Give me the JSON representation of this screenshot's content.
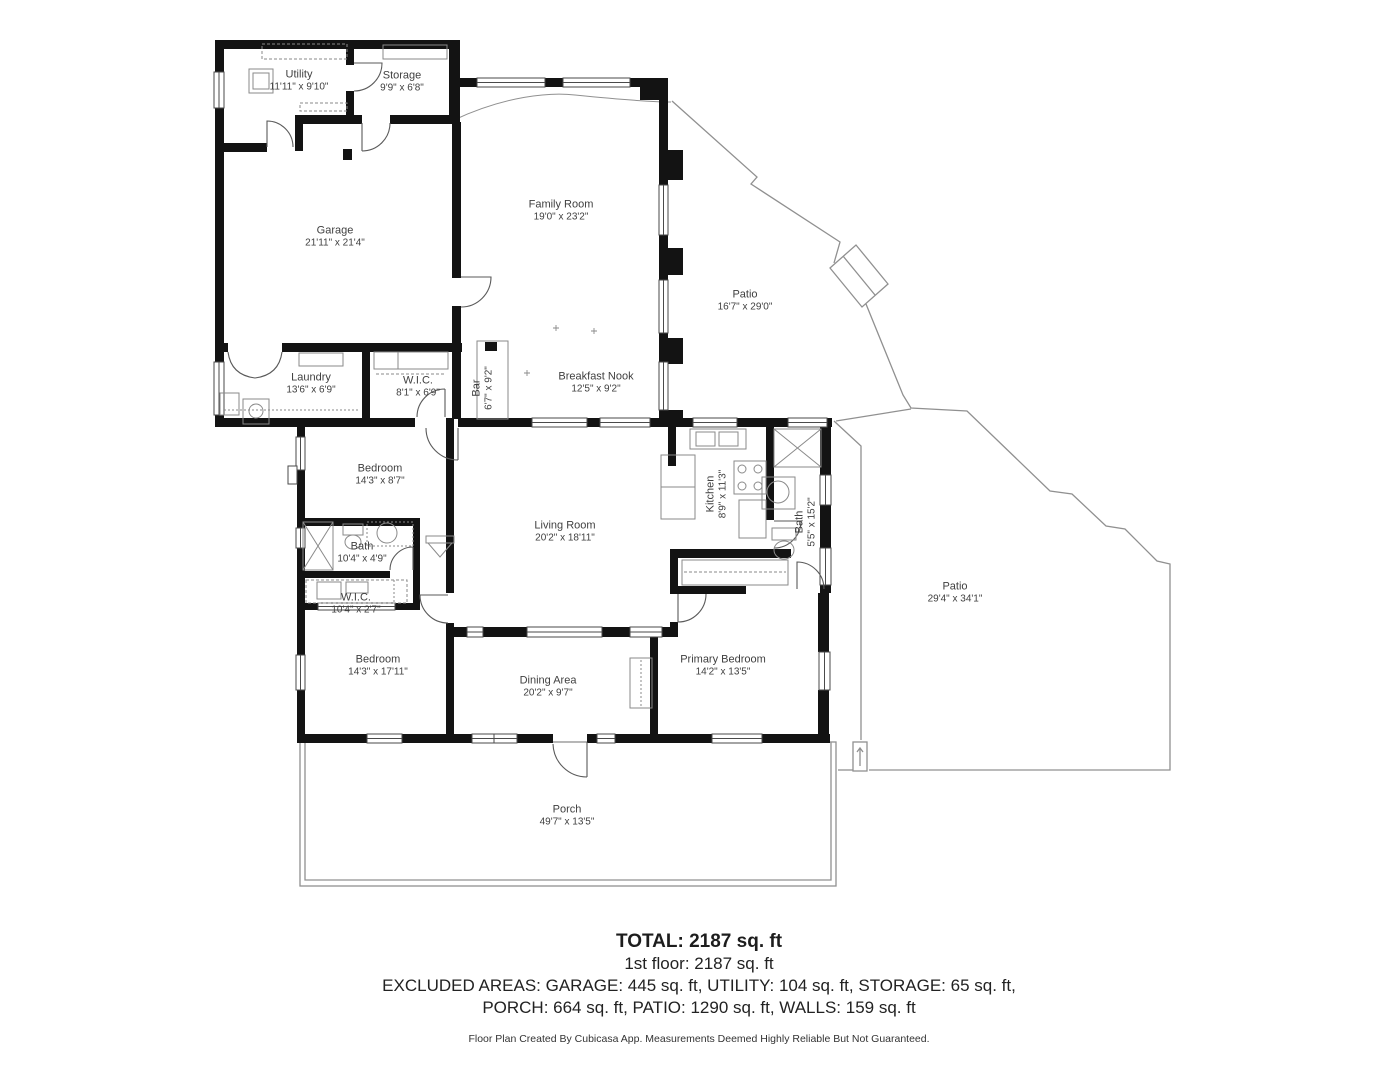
{
  "rooms": {
    "utility": {
      "name": "Utility",
      "dims": "11'11\" x 9'10\""
    },
    "storage": {
      "name": "Storage",
      "dims": "9'9\" x 6'8\""
    },
    "garage": {
      "name": "Garage",
      "dims": "21'11\" x 21'4\""
    },
    "family_room": {
      "name": "Family Room",
      "dims": "19'0\" x 23'2\""
    },
    "patio_upper": {
      "name": "Patio",
      "dims": "16'7\" x 29'0\""
    },
    "laundry": {
      "name": "Laundry",
      "dims": "13'6\" x 6'9\""
    },
    "wic_upper": {
      "name": "W.I.C.",
      "dims": "8'1\" x 6'9\""
    },
    "bar": {
      "name": "Bar",
      "dims": "6'7\" x 9'2\""
    },
    "breakfast_nook": {
      "name": "Breakfast Nook",
      "dims": "12'5\" x 9'2\""
    },
    "bedroom_upper": {
      "name": "Bedroom",
      "dims": "14'3\" x 8'7\""
    },
    "kitchen": {
      "name": "Kitchen",
      "dims": "8'9\" x 11'3\""
    },
    "bath_right": {
      "name": "Bath",
      "dims": "5'5\" x 15'2\""
    },
    "living_room": {
      "name": "Living Room",
      "dims": "20'2\" x 18'11\""
    },
    "bath_left": {
      "name": "Bath",
      "dims": "10'4\" x 4'9\""
    },
    "wic_lower": {
      "name": "W.I.C.",
      "dims": "10'4\" x 2'7\""
    },
    "bedroom_lower": {
      "name": "Bedroom",
      "dims": "14'3\" x 17'11\""
    },
    "dining_area": {
      "name": "Dining Area",
      "dims": "20'2\" x 9'7\""
    },
    "primary_bedroom": {
      "name": "Primary Bedroom",
      "dims": "14'2\" x 13'5\""
    },
    "patio_right": {
      "name": "Patio",
      "dims": "29'4\" x 34'1\""
    },
    "porch": {
      "name": "Porch",
      "dims": "49'7\" x 13'5\""
    }
  },
  "summary": {
    "total": "TOTAL: 2187 sq. ft",
    "floor": "1st floor: 2187 sq. ft",
    "excluded_line1": "EXCLUDED AREAS: GARAGE: 445 sq. ft, UTILITY: 104 sq. ft, STORAGE: 65 sq. ft,",
    "excluded_line2": "PORCH: 664 sq. ft, PATIO: 1290 sq. ft, WALLS: 159 sq. ft",
    "disclaimer": "Floor Plan Created By Cubicasa App. Measurements Deemed Highly Reliable But Not Guaranteed."
  },
  "colors": {
    "wall": "#131313",
    "thin_line": "#8a8a8a",
    "text": "#3f3f3f"
  }
}
